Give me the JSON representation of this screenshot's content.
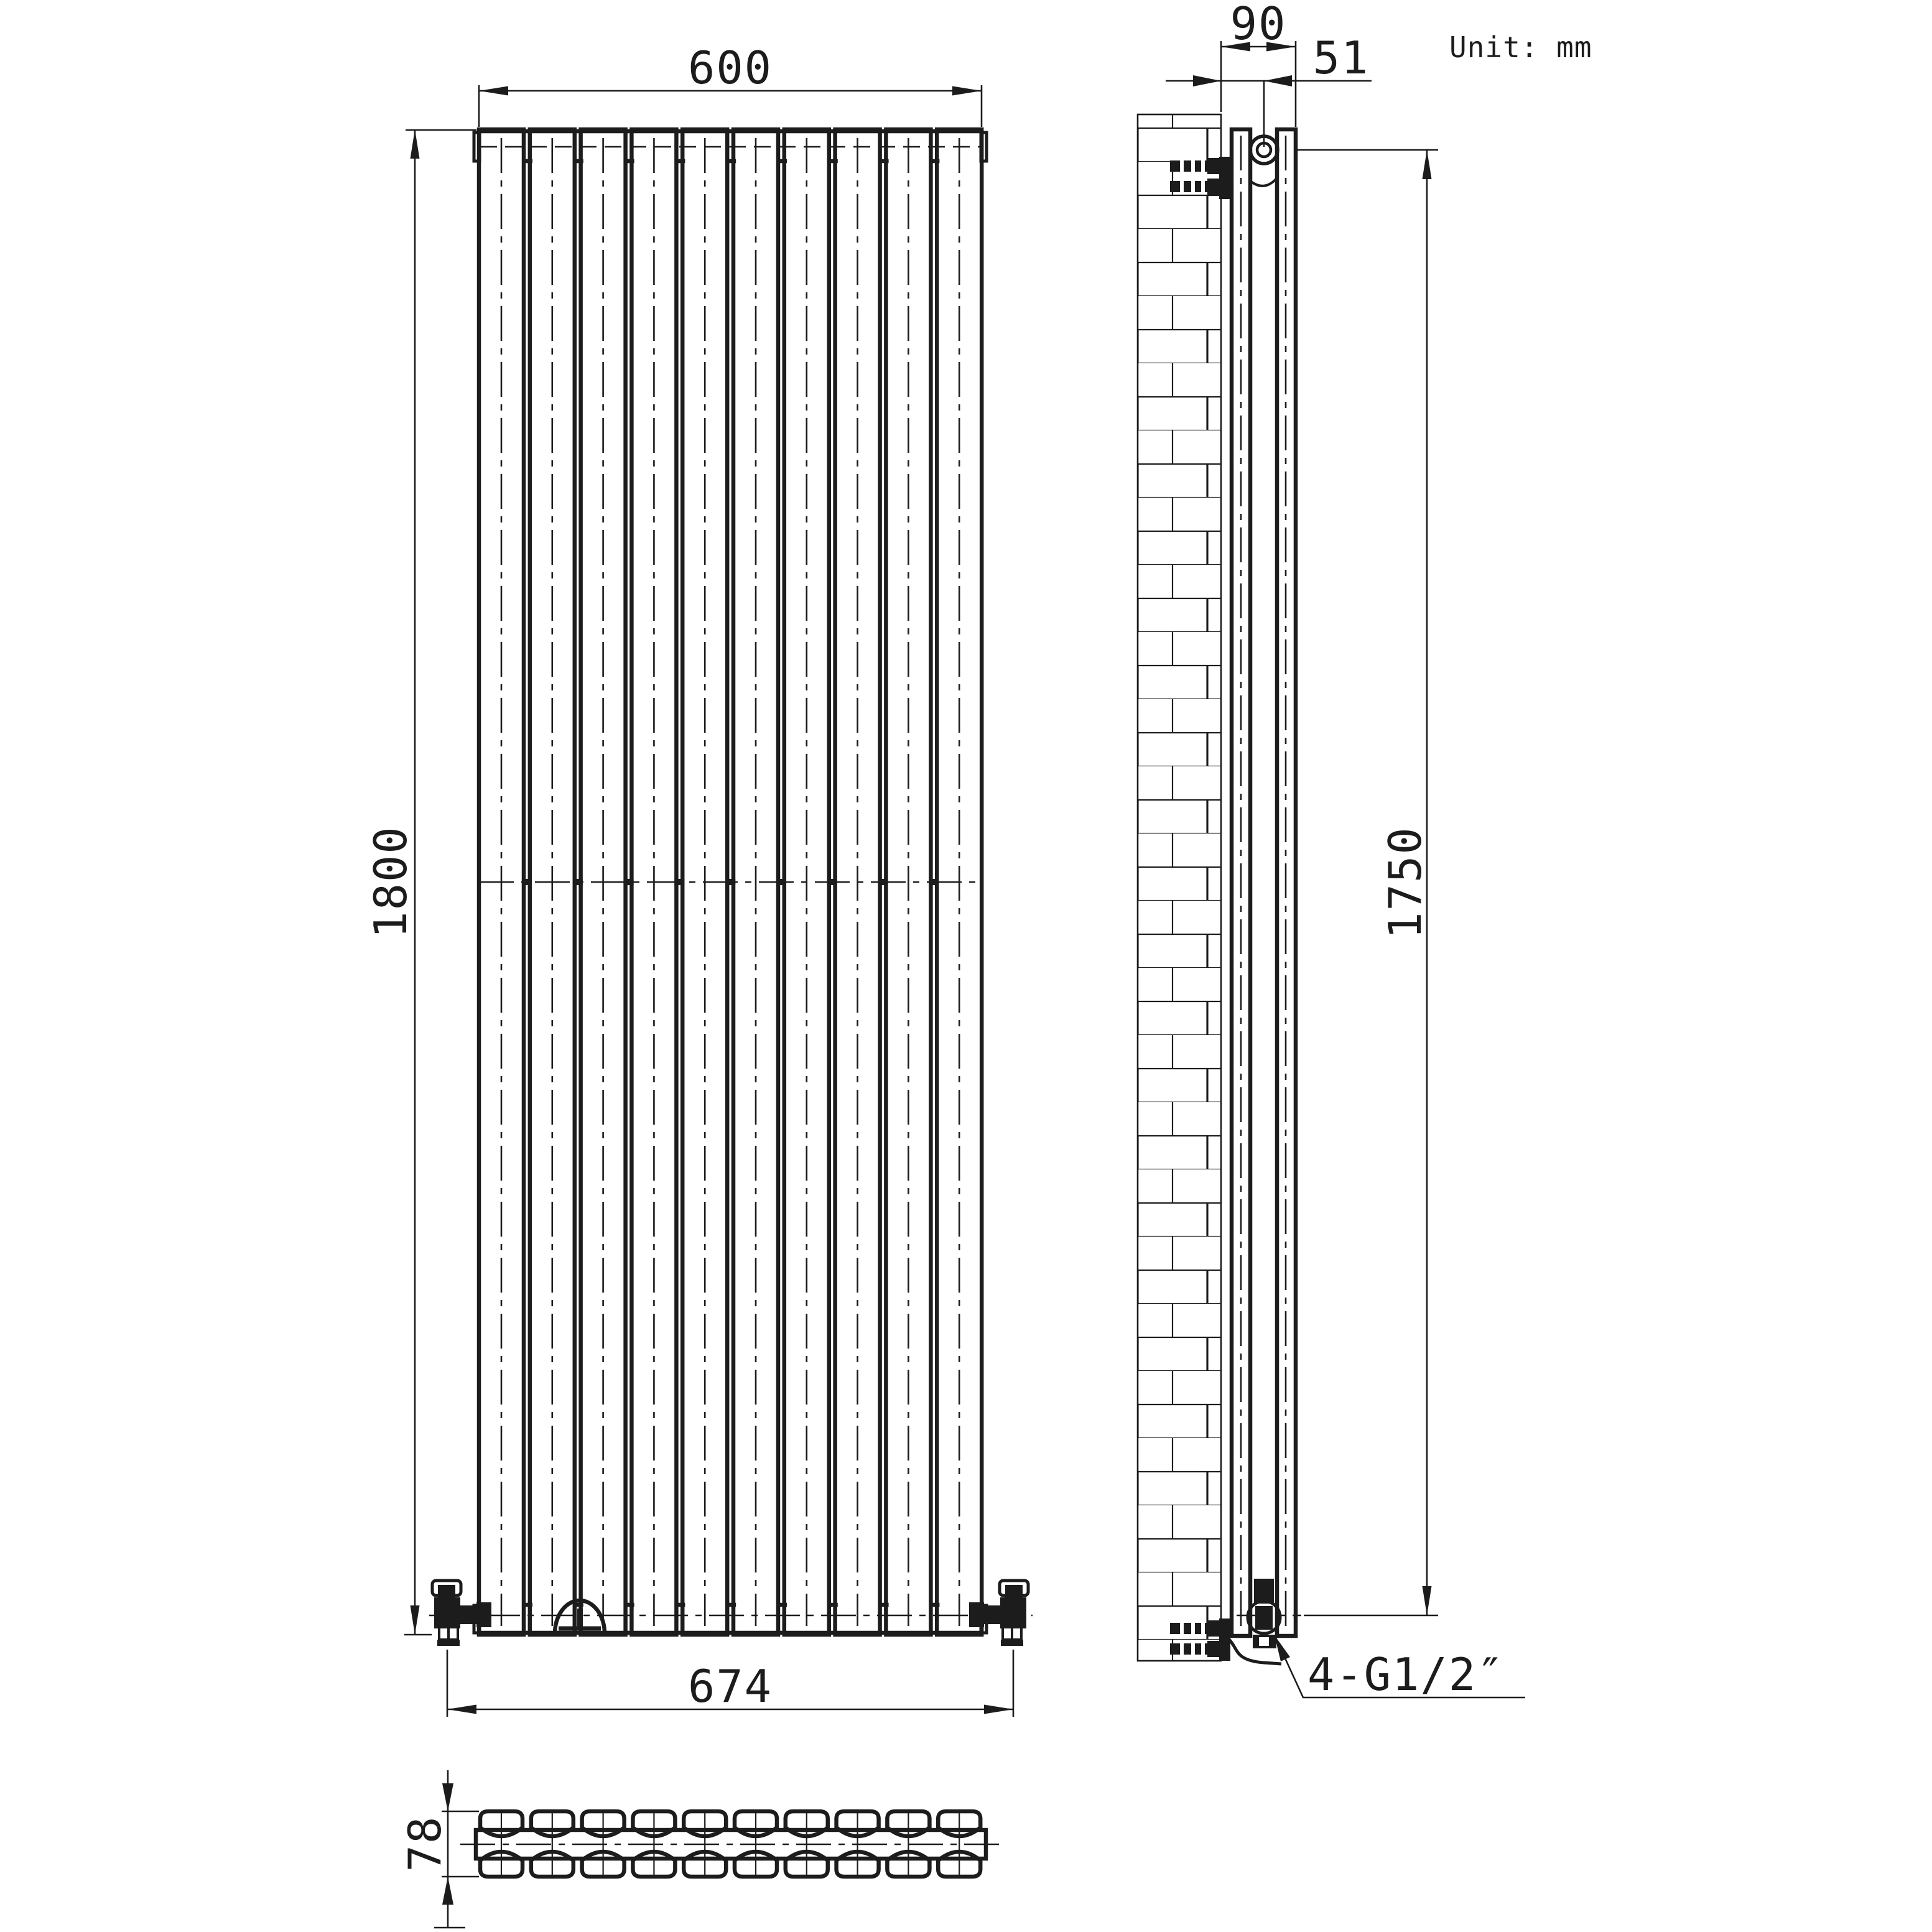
{
  "unit_note": "Unit: mm",
  "front_view": {
    "width_mm": "600",
    "height_mm": "1800",
    "valve_centres_mm": "674",
    "panel_count": 10
  },
  "side_view": {
    "depth_from_wall_mm": "90",
    "pipe_centre_offset_mm": "51",
    "mount_span_mm": "1750",
    "connection_thread": "4-G1/2″"
  },
  "top_view": {
    "depth_mm": "78",
    "columns_per_row": 10,
    "rows": 2
  },
  "colors": {
    "line": "#1c1c1c",
    "background": "#ffffff"
  }
}
